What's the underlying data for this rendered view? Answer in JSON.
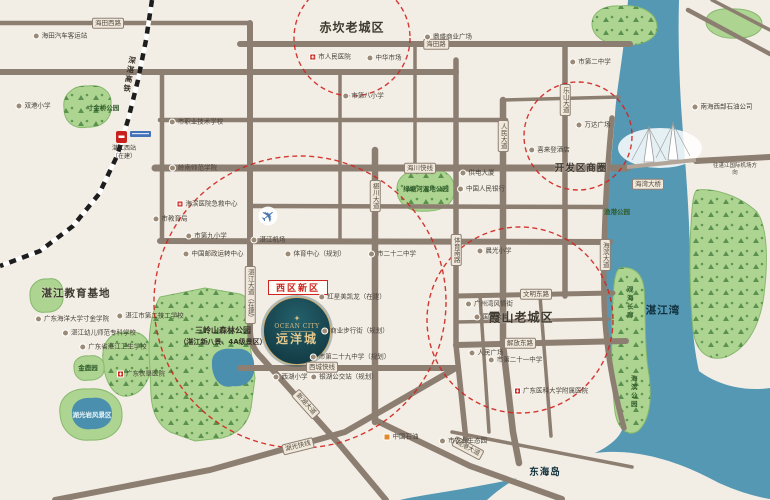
{
  "brand": {
    "en": "OCEAN CITY",
    "cn": "远洋城",
    "district_badge": "西区新区"
  },
  "districts": [
    {
      "t": "赤坎老城区",
      "x": 352,
      "y": 27,
      "s": 12
    },
    {
      "t": "开发区商圈",
      "x": 581,
      "y": 167,
      "s": 9.5
    },
    {
      "t": "霞山老城区",
      "x": 521,
      "y": 317,
      "s": 12
    },
    {
      "t": "湛江教育基地",
      "x": 76,
      "y": 293,
      "s": 10.5
    },
    {
      "t": "东海岛",
      "x": 545,
      "y": 471,
      "s": 9.5,
      "w": 1
    },
    {
      "t": "湛江湾",
      "x": 663,
      "y": 310,
      "s": 10.5,
      "w": 1
    }
  ],
  "forest_label": {
    "line1": "三岭山森林公园",
    "line2": "（湛江新八景、4A级景区）"
  },
  "railway": {
    "name": "深湛高铁",
    "station": "湛江西站",
    "status": "（在建）"
  },
  "edge_note": {
    "t": "往湛江国际机场方向"
  },
  "road_chips": [
    {
      "t": "海田西路",
      "x": 108,
      "y": 23
    },
    {
      "t": "海田路",
      "x": 436,
      "y": 44
    },
    {
      "t": "海川快线",
      "x": 420,
      "y": 168
    },
    {
      "t": "椹川大道",
      "x": 375,
      "y": 196,
      "v": 1
    },
    {
      "t": "体育南路",
      "x": 456,
      "y": 250,
      "v": 1
    },
    {
      "t": "人民大道",
      "x": 503,
      "y": 136,
      "v": 1
    },
    {
      "t": "乐山大道",
      "x": 565,
      "y": 100,
      "v": 1
    },
    {
      "t": "海滨大道",
      "x": 605,
      "y": 255,
      "v": 1
    },
    {
      "t": "湛江大道（在建）",
      "x": 250,
      "y": 295,
      "v": 1
    },
    {
      "t": "文明东路",
      "x": 536,
      "y": 294
    },
    {
      "t": "解放东路",
      "x": 520,
      "y": 343
    },
    {
      "t": "西城快线",
      "x": 322,
      "y": 367
    },
    {
      "t": "湖光快线",
      "x": 298,
      "y": 446,
      "r": -14
    },
    {
      "t": "新湖大道",
      "x": 306,
      "y": 404,
      "r": 48
    },
    {
      "t": "疏港大道",
      "x": 468,
      "y": 448,
      "r": 28
    },
    {
      "t": "海湾大桥",
      "x": 648,
      "y": 184
    }
  ],
  "pois": [
    {
      "t": "海田汽车客运站",
      "x": 60,
      "y": 36
    },
    {
      "t": "双港小学",
      "x": 33,
      "y": 106
    },
    {
      "t": "寸金桥公园",
      "x": 103,
      "y": 108,
      "ty": "park"
    },
    {
      "t": "市职业技术学校",
      "x": 196,
      "y": 122
    },
    {
      "t": "岭南师范学院",
      "x": 193,
      "y": 168
    },
    {
      "t": "市人民医院",
      "x": 330,
      "y": 57,
      "ic": "hosp"
    },
    {
      "t": "中华市场",
      "x": 384,
      "y": 58
    },
    {
      "t": "市第八小学",
      "x": 363,
      "y": 96
    },
    {
      "t": "鼎盛商业广场",
      "x": 448,
      "y": 37
    },
    {
      "t": "市第二中学",
      "x": 590,
      "y": 62
    },
    {
      "t": "万达广场",
      "x": 593,
      "y": 125
    },
    {
      "t": "喜来登酒店",
      "x": 549,
      "y": 150
    },
    {
      "t": "南海西部石油公司",
      "x": 722,
      "y": 107
    },
    {
      "t": "渔港公园",
      "x": 617,
      "y": 212,
      "ty": "park"
    },
    {
      "t": "海滨医院急救中心",
      "x": 207,
      "y": 204,
      "ic": "hosp"
    },
    {
      "t": "市教育局",
      "x": 170,
      "y": 219
    },
    {
      "t": "市第九小学",
      "x": 206,
      "y": 236
    },
    {
      "t": "中国邮政运转中心",
      "x": 213,
      "y": 254
    },
    {
      "t": "湛江机场",
      "x": 268,
      "y": 240
    },
    {
      "t": "体育中心（规划）",
      "x": 315,
      "y": 254
    },
    {
      "t": "供电大厦",
      "x": 477,
      "y": 173
    },
    {
      "t": "中国人民银行",
      "x": 481,
      "y": 189
    },
    {
      "t": "绿塘河湿地公园",
      "x": 426,
      "y": 189,
      "ty": "park"
    },
    {
      "t": "市二十二中学",
      "x": 392,
      "y": 254
    },
    {
      "t": "晨光小学",
      "x": 494,
      "y": 251
    },
    {
      "t": "红星美凯龙（在建）",
      "x": 352,
      "y": 297
    },
    {
      "t": "商业步行街（规划）",
      "x": 355,
      "y": 331
    },
    {
      "t": "广州湾风情街",
      "x": 489,
      "y": 304
    },
    {
      "t": "国贸大厦",
      "x": 491,
      "y": 317
    },
    {
      "t": "人民广场",
      "x": 486,
      "y": 353
    },
    {
      "t": "市第二十一中学",
      "x": 515,
      "y": 360
    },
    {
      "t": "广东医科大学附属医院",
      "x": 551,
      "y": 391,
      "ic": "hosp"
    },
    {
      "t": "观海长廊",
      "x": 629,
      "y": 303,
      "ty": "park",
      "v": 1
    },
    {
      "t": "海滨公园",
      "x": 633,
      "y": 392,
      "ty": "park",
      "v": 1
    },
    {
      "t": "市第二十九中学（规划）",
      "x": 350,
      "y": 357
    },
    {
      "t": "银湖公交站（规划）",
      "x": 344,
      "y": 377
    },
    {
      "t": "西湖小学",
      "x": 290,
      "y": 377
    },
    {
      "t": "中国石油",
      "x": 401,
      "y": 437,
      "ic": "gas"
    },
    {
      "t": "市农业生态园",
      "x": 463,
      "y": 441
    },
    {
      "t": "广东海洋大学寸金学院",
      "x": 72,
      "y": 319
    },
    {
      "t": "湛江市第二技工学校",
      "x": 150,
      "y": 316
    },
    {
      "t": "湛江幼儿师范专科学校",
      "x": 99,
      "y": 333
    },
    {
      "t": "广东省湛江卫生学校",
      "x": 113,
      "y": 347
    },
    {
      "t": "金鹿园",
      "x": 88,
      "y": 368,
      "ty": "park"
    },
    {
      "t": "广东农垦医院",
      "x": 141,
      "y": 374,
      "ic": "hosp"
    },
    {
      "t": "湖光岩风景区",
      "x": 92,
      "y": 415,
      "ty": "water"
    }
  ]
}
